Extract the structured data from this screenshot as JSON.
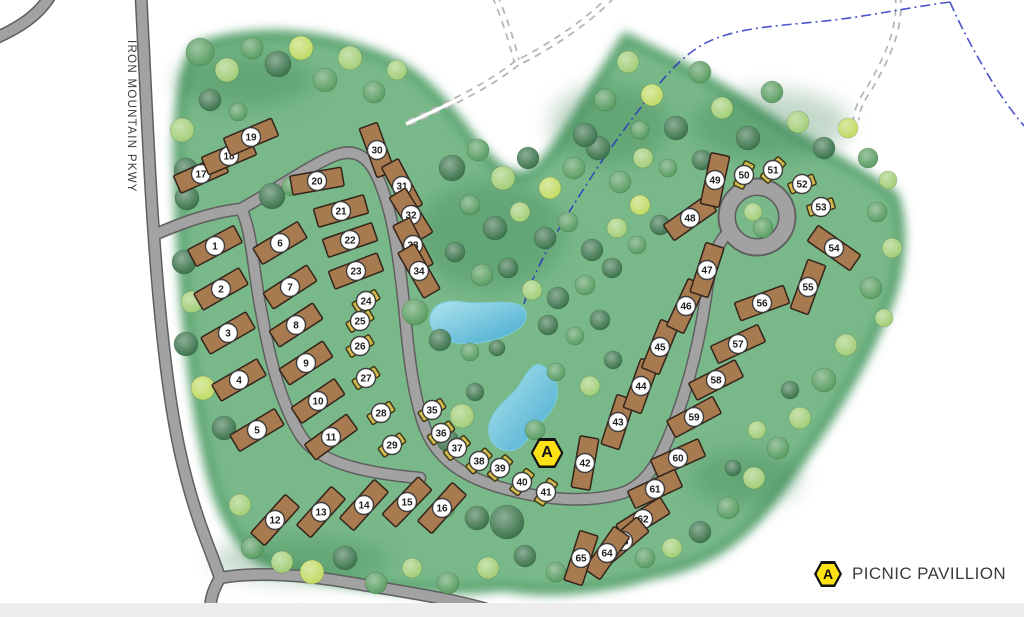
{
  "road_label": "IRON MOUNTAIN PKWY",
  "legend": {
    "marker_letter": "A",
    "label": "PICNIC PAVILLION"
  },
  "pavilion": {
    "letter": "A",
    "x": 547,
    "y": 453
  },
  "colors": {
    "green_base": "#79b989",
    "green_rim": "#55a06c",
    "shade": "#2e7747",
    "road_fill": "#a2a2a2",
    "road_casing": "#5f5f5f",
    "trail": "#b5b5b5",
    "stream": "#2a35c0",
    "pond_light": "#aee4ee",
    "pond_deep": "#45aacf",
    "cabin": "#a87a50",
    "cabin_border": "#33241a",
    "tent": "#d2b94f",
    "tent_border": "#3e3a17",
    "badge_bg": "#ffffff",
    "badge_border": "#3d3d3d",
    "badge_text": "#1d1d1d",
    "hex_fill": "#ffe215",
    "hex_border": "#141414",
    "label_text": "#3b3b3b",
    "footer": "#ededed"
  },
  "tree_palette": [
    "#2f6b40",
    "#4f9757",
    "#9ccb6f",
    "#bcd95b",
    "#d8ecc0"
  ],
  "sites": [
    [
      1,
      215,
      246,
      -28,
      "c"
    ],
    [
      2,
      221,
      289,
      -30,
      "c"
    ],
    [
      3,
      228,
      333,
      -30,
      "c"
    ],
    [
      4,
      239,
      380,
      -30,
      "c"
    ],
    [
      5,
      257,
      430,
      -31,
      "c"
    ],
    [
      6,
      280,
      243,
      -31,
      "c"
    ],
    [
      7,
      290,
      287,
      -33,
      "c"
    ],
    [
      8,
      296,
      325,
      -33,
      "c"
    ],
    [
      9,
      306,
      363,
      -33,
      "c"
    ],
    [
      10,
      318,
      401,
      -34,
      "c"
    ],
    [
      11,
      331,
      437,
      -36,
      "c"
    ],
    [
      12,
      275,
      520,
      -48,
      "c"
    ],
    [
      13,
      321,
      512,
      -48,
      "c"
    ],
    [
      14,
      364,
      505,
      -48,
      "c"
    ],
    [
      15,
      407,
      502,
      -46,
      "c"
    ],
    [
      16,
      442,
      508,
      -48,
      "c"
    ],
    [
      17,
      201,
      174,
      -24,
      "c"
    ],
    [
      18,
      229,
      156,
      -23,
      "c"
    ],
    [
      19,
      251,
      137,
      -23,
      "c"
    ],
    [
      20,
      317,
      181,
      -10,
      "c"
    ],
    [
      21,
      341,
      211,
      -16,
      "c"
    ],
    [
      22,
      350,
      240,
      -19,
      "c"
    ],
    [
      23,
      356,
      271,
      -21,
      "c"
    ],
    [
      24,
      366,
      301,
      -32,
      "t"
    ],
    [
      25,
      360,
      321,
      -31,
      "t"
    ],
    [
      26,
      360,
      346,
      -31,
      "t"
    ],
    [
      27,
      366,
      378,
      -33,
      "t"
    ],
    [
      28,
      381,
      413,
      -33,
      "t"
    ],
    [
      29,
      392,
      445,
      -36,
      "t"
    ],
    [
      30,
      377,
      150,
      70,
      "c"
    ],
    [
      31,
      402,
      186,
      62,
      "c"
    ],
    [
      32,
      411,
      215,
      58,
      "c"
    ],
    [
      33,
      413,
      245,
      63,
      "c"
    ],
    [
      34,
      419,
      271,
      60,
      "c"
    ],
    [
      35,
      432,
      410,
      -33,
      "t"
    ],
    [
      36,
      441,
      433,
      -36,
      "t"
    ],
    [
      37,
      457,
      448,
      -40,
      "t"
    ],
    [
      38,
      479,
      461,
      -44,
      "t"
    ],
    [
      39,
      500,
      468,
      -48,
      "t"
    ],
    [
      40,
      522,
      482,
      -52,
      "t"
    ],
    [
      41,
      546,
      492,
      -57,
      "t"
    ],
    [
      42,
      585,
      463,
      -80,
      "c"
    ],
    [
      43,
      618,
      422,
      -72,
      "c"
    ],
    [
      44,
      641,
      386,
      -70,
      "c"
    ],
    [
      45,
      660,
      347,
      -68,
      "c"
    ],
    [
      46,
      686,
      306,
      -65,
      "c"
    ],
    [
      47,
      707,
      270,
      -72,
      "c"
    ],
    [
      48,
      690,
      218,
      -35,
      "c"
    ],
    [
      49,
      715,
      180,
      -78,
      "c"
    ],
    [
      50,
      744,
      175,
      -64,
      "t"
    ],
    [
      51,
      773,
      170,
      -48,
      "t"
    ],
    [
      52,
      802,
      184,
      -22,
      "t"
    ],
    [
      53,
      821,
      207,
      -18,
      "t"
    ],
    [
      54,
      834,
      248,
      35,
      "c"
    ],
    [
      55,
      808,
      287,
      -70,
      "c"
    ],
    [
      56,
      762,
      303,
      -20,
      "c"
    ],
    [
      57,
      738,
      344,
      -25,
      "c"
    ],
    [
      58,
      716,
      380,
      -27,
      "c"
    ],
    [
      59,
      694,
      417,
      -28,
      "c"
    ],
    [
      60,
      678,
      458,
      -24,
      "c"
    ],
    [
      61,
      655,
      489,
      -25,
      "c"
    ],
    [
      62,
      643,
      519,
      -32,
      "c"
    ],
    [
      63,
      623,
      541,
      -40,
      "c"
    ],
    [
      64,
      607,
      553,
      -55,
      "c"
    ],
    [
      65,
      581,
      558,
      -72,
      "c"
    ]
  ],
  "trees": [
    [
      200,
      52,
      14,
      1
    ],
    [
      227,
      70,
      12,
      2
    ],
    [
      252,
      48,
      11,
      1
    ],
    [
      278,
      64,
      13,
      0
    ],
    [
      301,
      48,
      12,
      3
    ],
    [
      325,
      80,
      12,
      1
    ],
    [
      350,
      58,
      12,
      2
    ],
    [
      374,
      92,
      11,
      1
    ],
    [
      397,
      70,
      10,
      2
    ],
    [
      210,
      100,
      11,
      0
    ],
    [
      238,
      112,
      9,
      1
    ],
    [
      182,
      130,
      12,
      2
    ],
    [
      186,
      170,
      12,
      0
    ],
    [
      187,
      198,
      12,
      0
    ],
    [
      184,
      262,
      12,
      0
    ],
    [
      192,
      302,
      11,
      2
    ],
    [
      186,
      344,
      12,
      0
    ],
    [
      203,
      388,
      12,
      3
    ],
    [
      224,
      428,
      12,
      0
    ],
    [
      240,
      505,
      11,
      2
    ],
    [
      272,
      196,
      13,
      0
    ],
    [
      292,
      186,
      10,
      1
    ],
    [
      415,
      312,
      13,
      1
    ],
    [
      440,
      340,
      11,
      0
    ],
    [
      452,
      168,
      13,
      0
    ],
    [
      478,
      150,
      11,
      1
    ],
    [
      503,
      178,
      12,
      2
    ],
    [
      528,
      158,
      11,
      0
    ],
    [
      550,
      188,
      11,
      3
    ],
    [
      574,
      168,
      11,
      1
    ],
    [
      598,
      148,
      12,
      0
    ],
    [
      620,
      182,
      11,
      1
    ],
    [
      643,
      158,
      10,
      2
    ],
    [
      470,
      205,
      10,
      1
    ],
    [
      495,
      228,
      12,
      0
    ],
    [
      520,
      212,
      10,
      2
    ],
    [
      545,
      238,
      11,
      0
    ],
    [
      568,
      222,
      10,
      1
    ],
    [
      592,
      250,
      11,
      0
    ],
    [
      617,
      228,
      10,
      2
    ],
    [
      640,
      205,
      10,
      3
    ],
    [
      455,
      252,
      10,
      0
    ],
    [
      482,
      275,
      11,
      1
    ],
    [
      508,
      268,
      10,
      0
    ],
    [
      532,
      290,
      10,
      2
    ],
    [
      558,
      298,
      11,
      0
    ],
    [
      585,
      285,
      10,
      1
    ],
    [
      612,
      268,
      10,
      0
    ],
    [
      637,
      245,
      9,
      1
    ],
    [
      660,
      225,
      10,
      0
    ],
    [
      548,
      325,
      10,
      0
    ],
    [
      575,
      336,
      9,
      1
    ],
    [
      600,
      320,
      10,
      0
    ],
    [
      470,
      352,
      9,
      1
    ],
    [
      497,
      348,
      8,
      0
    ],
    [
      556,
      372,
      9,
      1
    ],
    [
      590,
      386,
      10,
      2
    ],
    [
      613,
      360,
      9,
      0
    ],
    [
      475,
      392,
      9,
      0
    ],
    [
      462,
      416,
      12,
      2
    ],
    [
      448,
      441,
      11,
      0
    ],
    [
      535,
      430,
      10,
      1
    ],
    [
      585,
      135,
      12,
      0
    ],
    [
      605,
      100,
      11,
      1
    ],
    [
      628,
      62,
      11,
      2
    ],
    [
      652,
      95,
      11,
      3
    ],
    [
      676,
      128,
      12,
      0
    ],
    [
      700,
      72,
      11,
      1
    ],
    [
      722,
      108,
      11,
      2
    ],
    [
      748,
      138,
      12,
      0
    ],
    [
      772,
      92,
      11,
      1
    ],
    [
      798,
      122,
      11,
      2
    ],
    [
      824,
      148,
      11,
      0
    ],
    [
      848,
      128,
      10,
      3
    ],
    [
      868,
      158,
      10,
      1
    ],
    [
      888,
      180,
      9,
      2
    ],
    [
      702,
      160,
      10,
      0
    ],
    [
      668,
      168,
      9,
      1
    ],
    [
      640,
      130,
      9,
      1
    ],
    [
      753,
      212,
      9,
      2
    ],
    [
      763,
      228,
      10,
      1
    ],
    [
      877,
      212,
      10,
      1
    ],
    [
      892,
      248,
      10,
      2
    ],
    [
      871,
      288,
      11,
      1
    ],
    [
      884,
      318,
      9,
      2
    ],
    [
      846,
      345,
      11,
      2
    ],
    [
      824,
      380,
      12,
      1
    ],
    [
      800,
      418,
      11,
      2
    ],
    [
      778,
      448,
      11,
      1
    ],
    [
      754,
      478,
      11,
      2
    ],
    [
      728,
      508,
      11,
      1
    ],
    [
      700,
      532,
      11,
      0
    ],
    [
      672,
      548,
      10,
      2
    ],
    [
      645,
      558,
      10,
      1
    ],
    [
      757,
      430,
      9,
      2
    ],
    [
      790,
      390,
      9,
      0
    ],
    [
      733,
      468,
      8,
      0
    ],
    [
      252,
      548,
      11,
      1
    ],
    [
      282,
      562,
      11,
      2
    ],
    [
      312,
      572,
      12,
      3
    ],
    [
      345,
      558,
      12,
      0
    ],
    [
      376,
      583,
      11,
      1
    ],
    [
      412,
      568,
      10,
      2
    ],
    [
      448,
      583,
      11,
      1
    ],
    [
      488,
      568,
      11,
      2
    ],
    [
      525,
      556,
      11,
      0
    ],
    [
      556,
      572,
      10,
      1
    ],
    [
      507,
      522,
      17,
      0
    ],
    [
      477,
      518,
      12,
      0
    ],
    [
      445,
      508,
      10,
      1
    ]
  ],
  "geometry": {
    "green": "M 196,48 C 252,28 322,30 392,62 C 420,76 442,100 466,132 C 490,164 510,184 530,174 C 556,160 588,96 626,38 C 662,56 704,76 748,106 C 802,142 862,172 894,196 C 906,232 900,282 880,322 C 855,382 815,442 770,502 C 740,542 700,566 654,574 C 600,590 544,594 504,586 C 430,594 330,586 262,560 C 232,540 216,500 206,450 C 190,380 180,260 178,150 C 179,100 184,70 196,48 Z",
    "shades": [
      [
        490,
        235,
        75,
        55
      ],
      [
        610,
        125,
        60,
        40
      ],
      [
        245,
        80,
        70,
        28
      ],
      [
        770,
        125,
        80,
        35
      ],
      [
        745,
        478,
        55,
        28
      ],
      [
        300,
        560,
        90,
        22
      ]
    ],
    "roads": [
      "M -4,38 C 18,28 38,16 50,-4",
      "M 141,-4 C 147,110 151,230 163,340 C 172,425 184,482 206,540 C 212,556 217,568 220,578",
      "M 220,578 C 213,590 209,600 210,621",
      "M 220,578 C 252,572 302,574 352,583 C 404,592 465,600 508,616 L 514,621",
      "M 156,234 C 184,222 212,212 241,209",
      "M 241,209 C 252,230 253,270 261,310 C 269,355 279,400 301,436 C 316,459 352,472 420,478",
      "M 241,209 C 272,192 306,168 331,157 C 353,147 367,155 377,176 C 393,210 399,258 404,305 C 408,348 412,392 425,428 C 439,463 469,479 506,489 C 546,500 586,503 619,494 C 649,486 664,452 676,418 C 690,380 700,338 706,296 C 710,265 716,243 729,232"
    ],
    "culdesac": {
      "x": 757,
      "y": 217,
      "r": 30,
      "island_r": 21
    },
    "trails": [
      "M 495,-4 C 505,20 512,42 517,63",
      "M 612,-4 C 592,18 552,46 517,63",
      "M 517,63 C 488,86 452,103 406,124",
      "M 898,-4 C 901,30 886,60 869,89 C 860,102 857,110 856,120"
    ],
    "streams": [
      "M 950,2 C 905,8 860,18 815,22 C 775,26 740,28 712,40 C 688,50 668,72 648,98 C 628,124 610,148 592,176 C 574,204 556,232 543,258 C 533,278 527,292 524,304",
      "M 950,2 C 962,30 980,62 996,88 C 1008,106 1017,118 1026,128"
    ],
    "ponds": [
      "M 430,318 C 432,304 446,299 463,302 C 483,305 506,299 519,305 C 529,310 529,321 518,329 C 504,339 477,346 457,343 C 441,341 429,331 430,318 Z",
      "M 541,365 C 553,371 561,385 556,401 C 551,416 539,422 531,434 C 523,447 515,453 504,450 C 491,447 485,433 491,419 C 497,405 510,398 518,387 C 525,377 531,362 541,365 Z"
    ]
  }
}
